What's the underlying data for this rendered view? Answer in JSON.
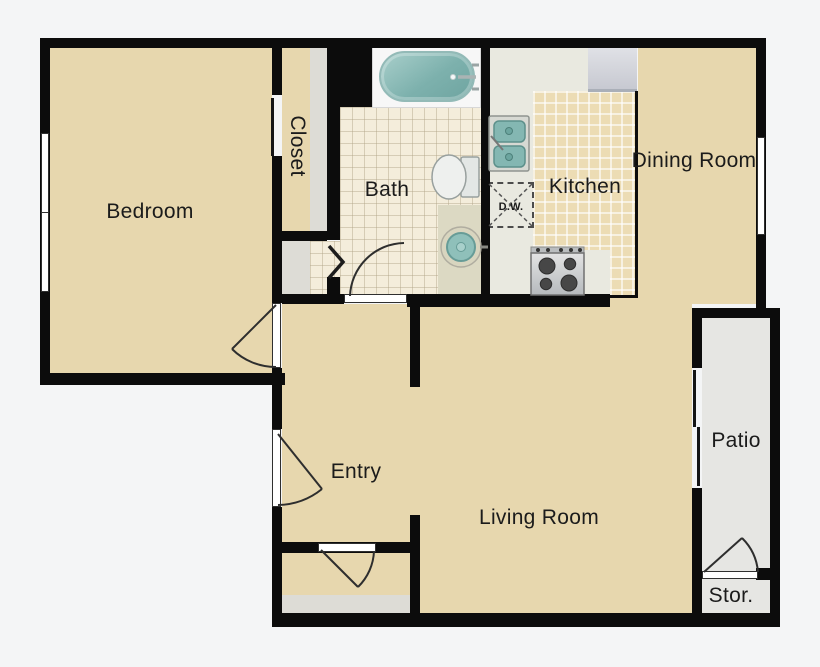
{
  "plan": {
    "type": "apartment-floor-plan",
    "rooms": {
      "bedroom": {
        "label": "Bedroom"
      },
      "closet": {
        "label": "Closet"
      },
      "bath": {
        "label": "Bath"
      },
      "kitchen": {
        "label": "Kitchen"
      },
      "dining": {
        "label": "Dining Room"
      },
      "entry": {
        "label": "Entry"
      },
      "living": {
        "label": "Living Room"
      },
      "patio": {
        "label": "Patio"
      },
      "storage": {
        "label": "Stor."
      }
    },
    "fixtures": {
      "dishwasher": {
        "label": "D.W."
      },
      "icons": [
        "bathtub-icon",
        "toilet-icon",
        "bath-sink-icon",
        "kitchen-sink-icon",
        "stove-icon",
        "fridge-icon"
      ]
    }
  },
  "colors": {
    "background": "#f4f5f6",
    "wall": "#0c0c0c",
    "floor_tan": "#e7d7ae",
    "tile_kitchen": "#ecdcb4",
    "tile_bath": "#f4eddb",
    "floor_gray": "#dddcd6",
    "patio_gray": "#e6e6e3",
    "counter": "#e9e9e0",
    "fixture_teal": "#8ec1bc",
    "appliance_gray": "#cfd1d6"
  }
}
